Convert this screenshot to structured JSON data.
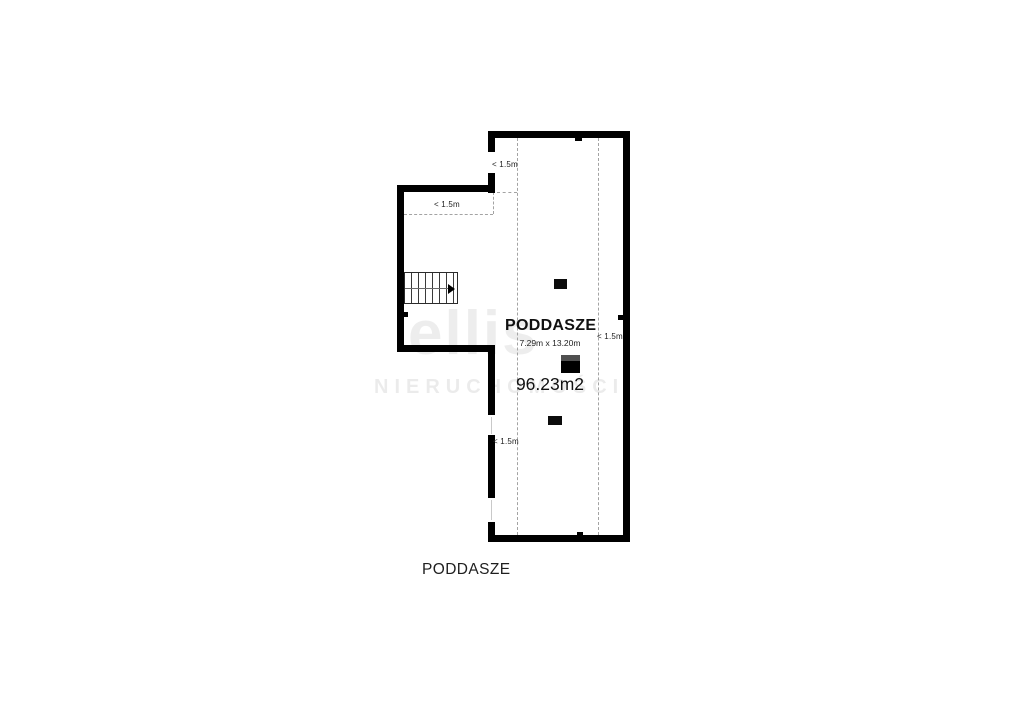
{
  "floor_plan": {
    "title": "PODDASZE",
    "dimensions": "7.29m x 13.20m",
    "area": "96.23m2",
    "caption": "PODDASZE",
    "height_restriction_labels": [
      {
        "id": "top-left-wall-gap",
        "text": "< 1.5m"
      },
      {
        "id": "extension-strip",
        "text": "< 1.5m"
      },
      {
        "id": "right-wall-strip",
        "text": "< 1.5m"
      },
      {
        "id": "lower-left-wall",
        "text": "< 1.5m"
      }
    ],
    "colors": {
      "wall": "#000000",
      "dashed_line": "#a3a3a3",
      "text": "#1c1c1c",
      "chimney_top": "#4f4f4f"
    }
  },
  "watermark": {
    "logo": "ellis",
    "subtitle": "NIERUCHOMOŚCI"
  }
}
